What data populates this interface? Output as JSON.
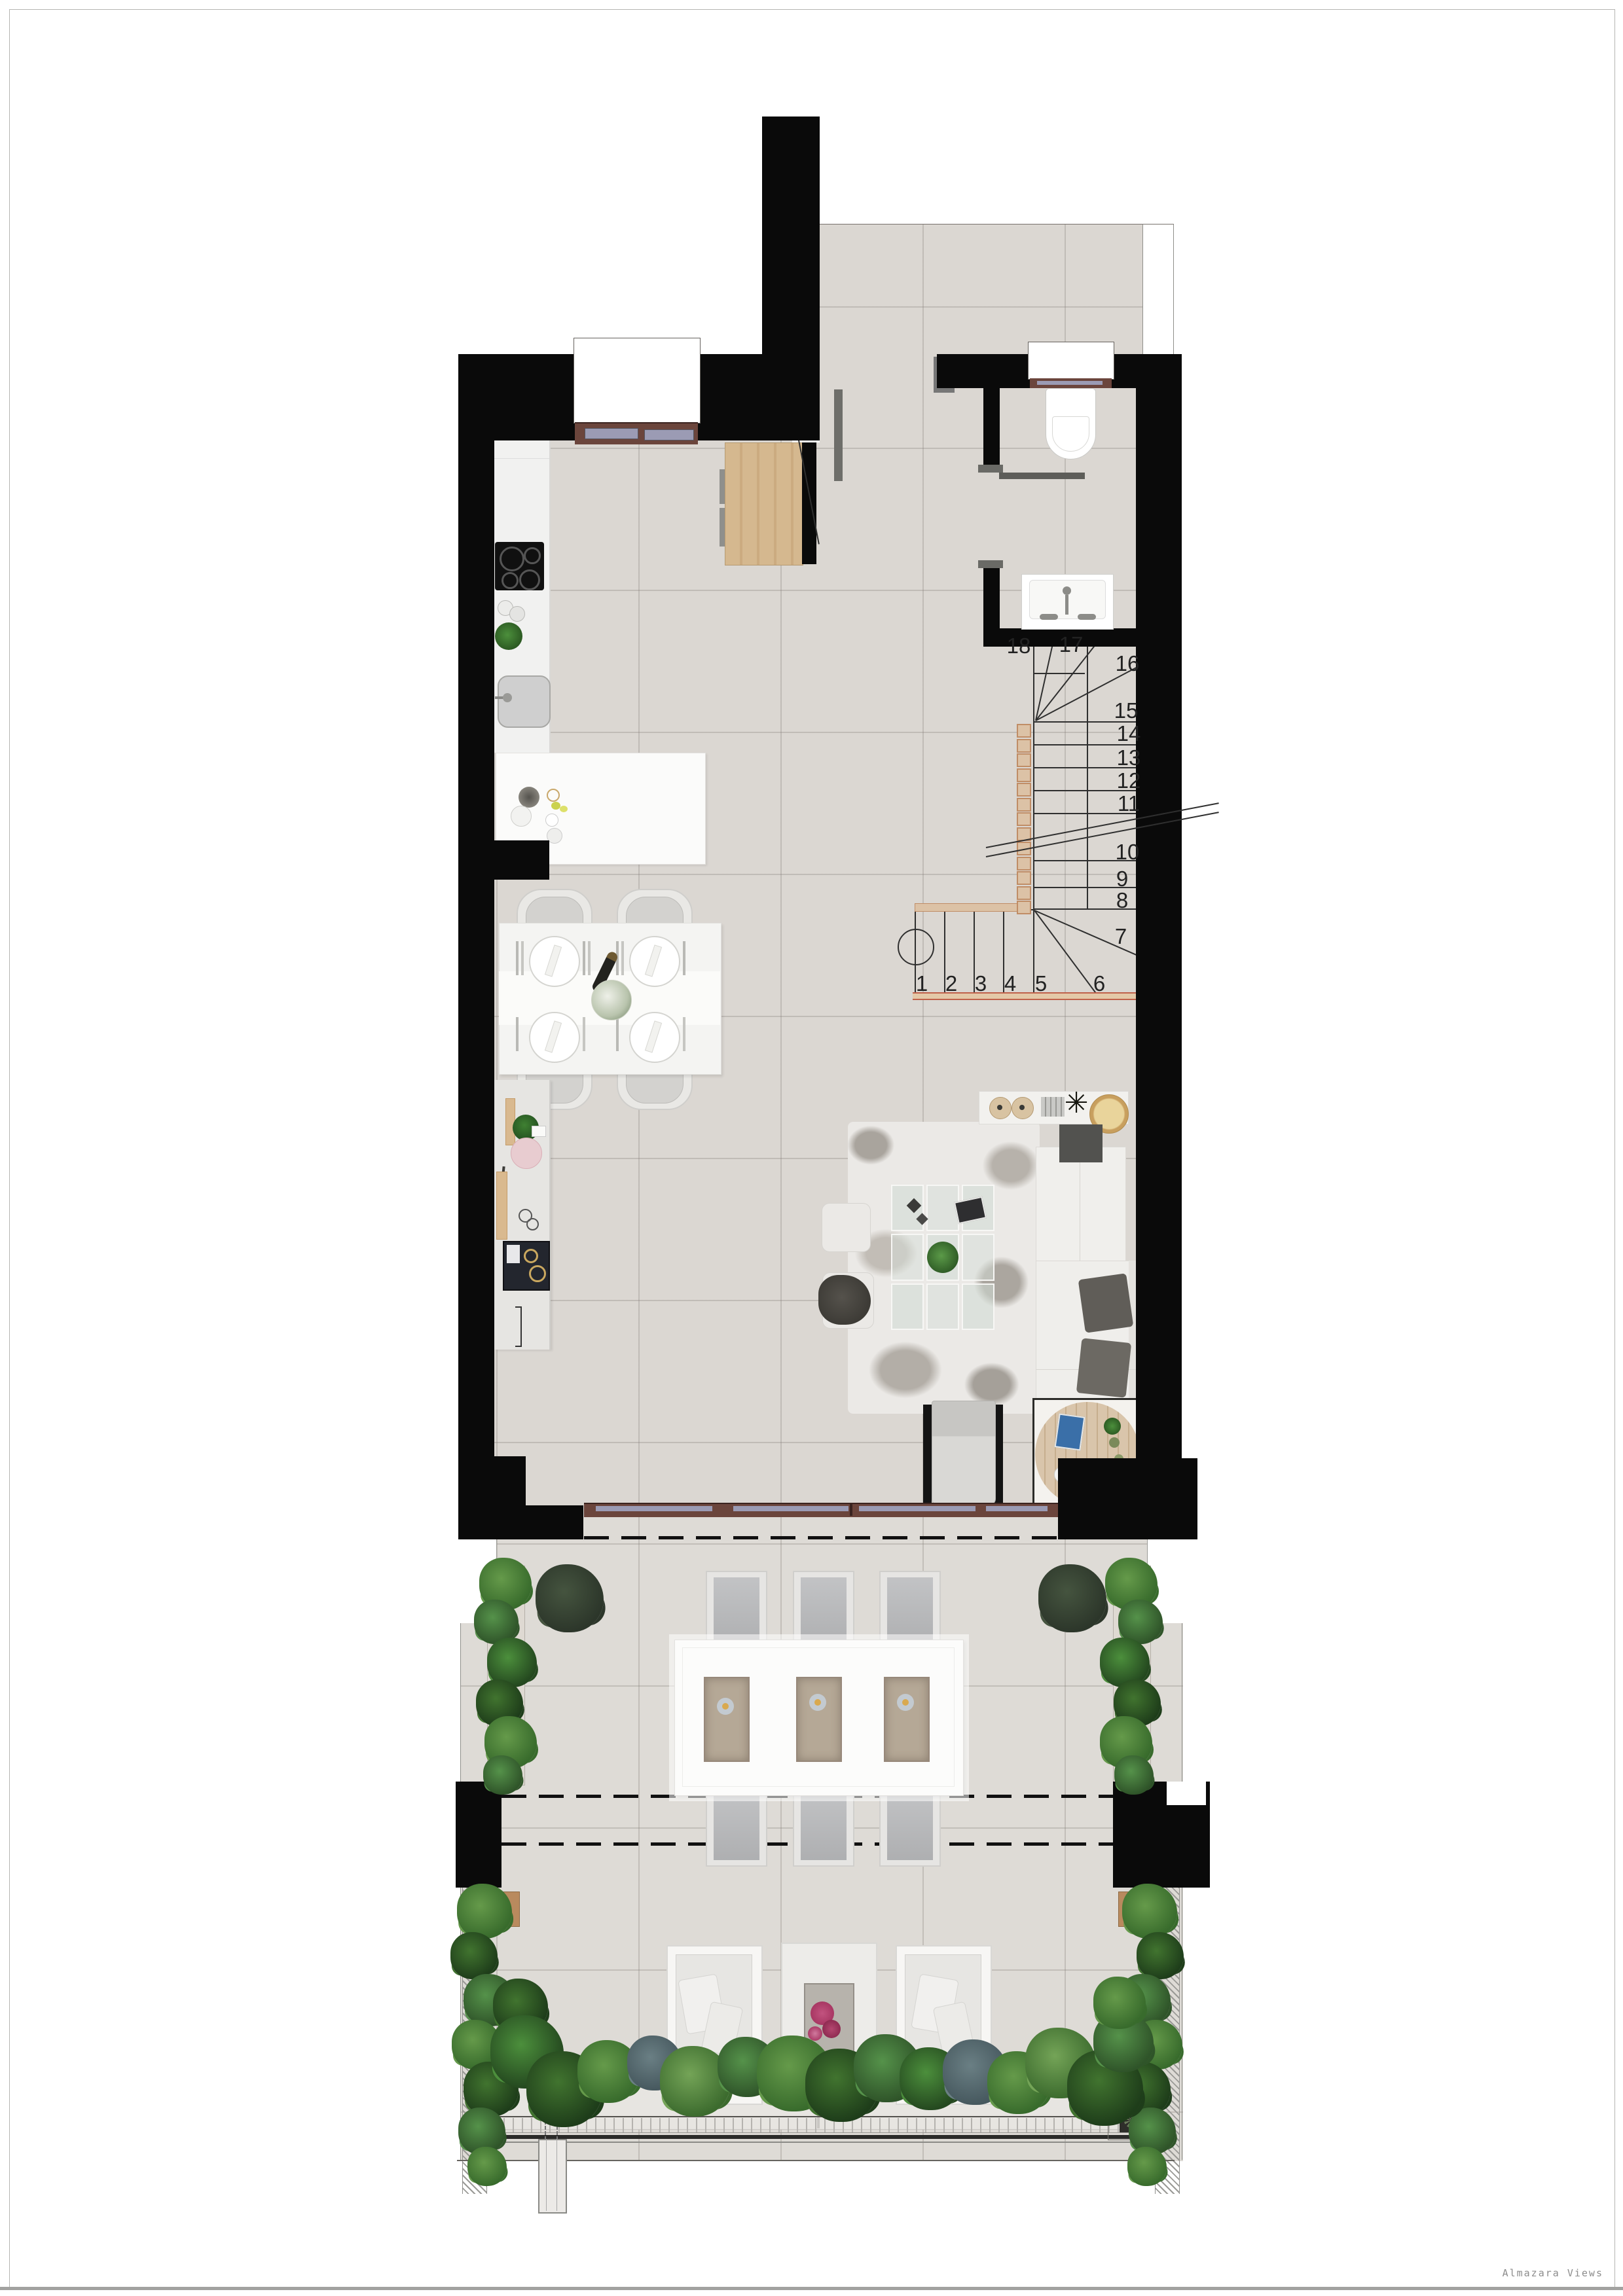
{
  "credit": {
    "label": "Almazara Views"
  },
  "stairs": {
    "steps": [
      "1",
      "2",
      "3",
      "4",
      "5",
      "6",
      "7",
      "8",
      "9",
      "10",
      "11",
      "12",
      "13",
      "14",
      "15",
      "16",
      "17",
      "18"
    ]
  },
  "palette": {
    "wall": "#0a0a0a",
    "interior_floor": "#dbd7d2",
    "terrace_floor": "#dedbd6",
    "wood_wardrobe": "#d5b88f",
    "window_frame_brown": "#6b453c",
    "window_glass": "#9b9bb4",
    "stair_accent_tan": "#dcc2a6",
    "stair_accent_red": "#c0614a",
    "plant_green": "#386b2c",
    "furniture_white": "#f5f4f2"
  }
}
